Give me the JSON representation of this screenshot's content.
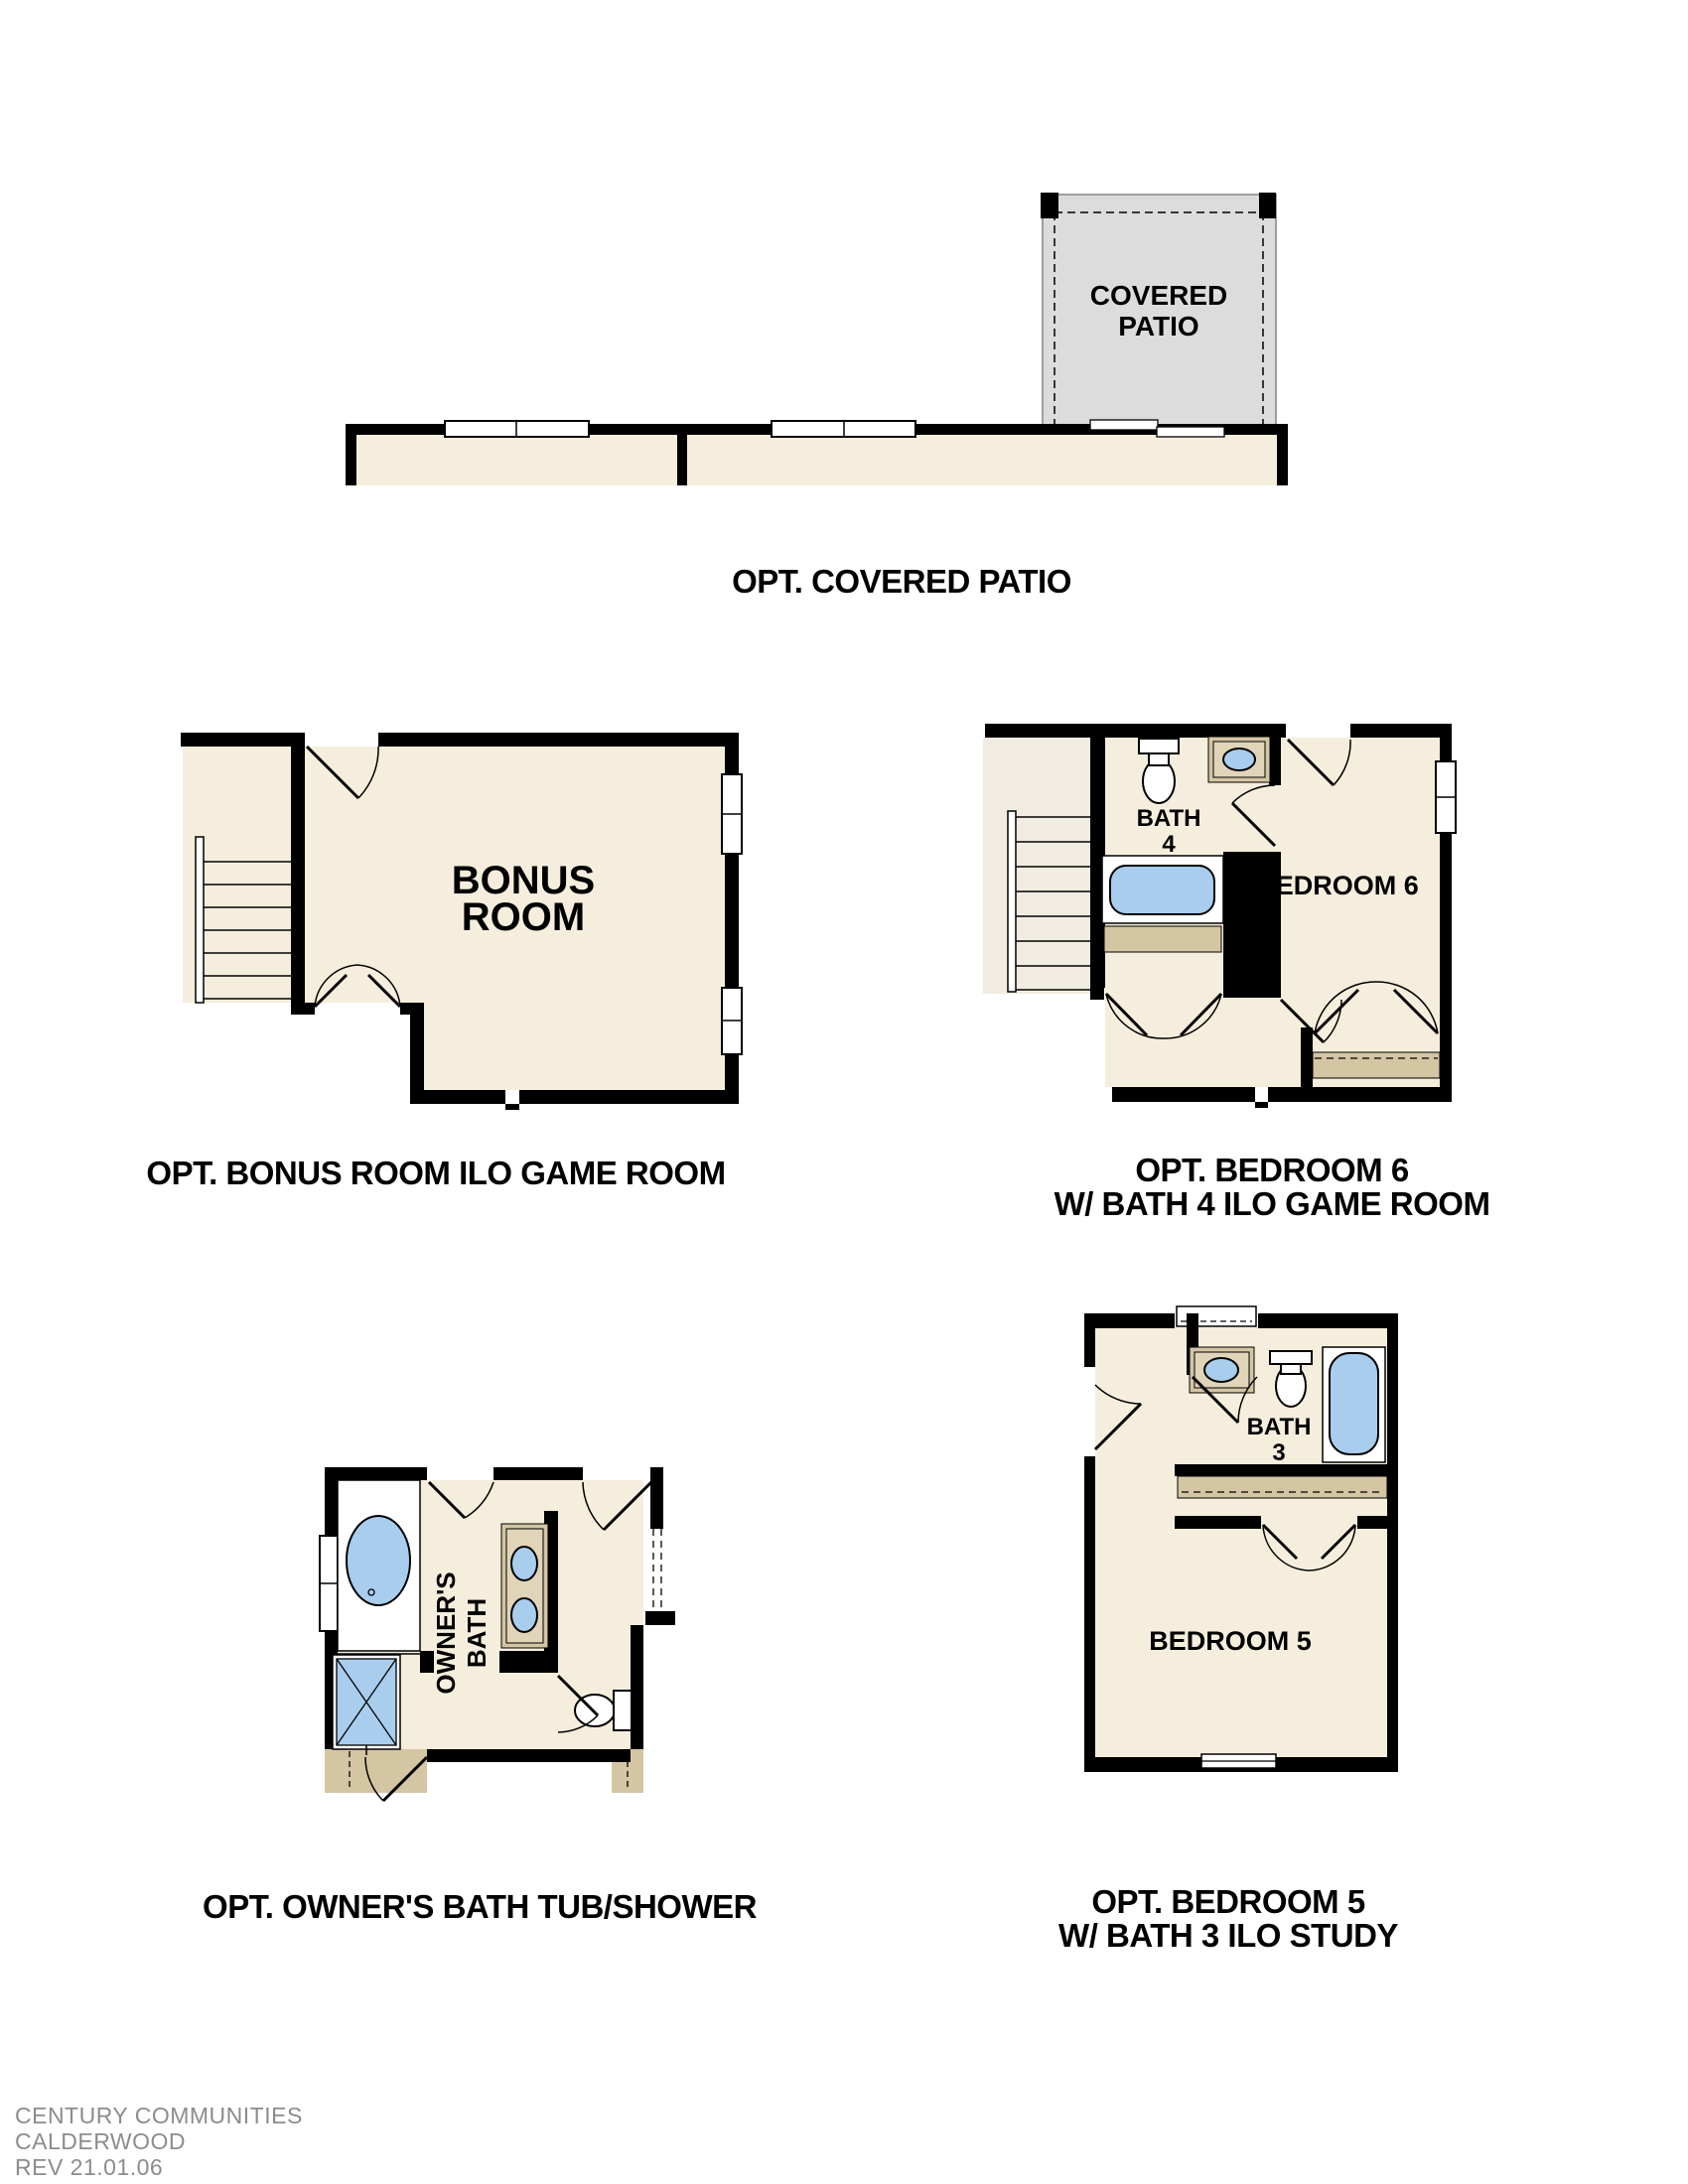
{
  "document": {
    "type": "floor-plan-options-sheet",
    "background": "#ffffff"
  },
  "colors": {
    "floor_beige": "#f5eedd",
    "stair_beige": "#f1ece1",
    "counter_tan": "#d4c5a3",
    "counter_tan_light": "#e0d5b9",
    "fixture_blue": "#a9cdec",
    "patio_gray": "#dcdcdc",
    "wall_black": "#000000",
    "footer_gray": "#8c8c8c"
  },
  "plans": {
    "covered_patio": {
      "caption": "OPT. COVERED PATIO",
      "room_label_line1": "COVERED",
      "room_label_line2": "PATIO"
    },
    "bonus_room": {
      "caption": "OPT. BONUS ROOM ILO GAME ROOM",
      "room_label_line1": "BONUS",
      "room_label_line2": "ROOM"
    },
    "bedroom6": {
      "caption_line1": "OPT. BEDROOM 6",
      "caption_line2": "W/ BATH 4 ILO GAME ROOM",
      "room_label": "BEDROOM 6",
      "bath_label_line1": "BATH",
      "bath_label_line2": "4"
    },
    "owners_bath": {
      "caption": "OPT. OWNER'S BATH TUB/SHOWER",
      "room_label_line1": "OWNER'S",
      "room_label_line2": "BATH"
    },
    "bedroom5": {
      "caption_line1": "OPT. BEDROOM 5",
      "caption_line2": "W/ BATH 3 ILO STUDY",
      "room_label": "BEDROOM 5",
      "bath_label_line1": "BATH",
      "bath_label_line2": "3"
    }
  },
  "footer": {
    "line1": "CENTURY COMMUNITIES",
    "line2": "CALDERWOOD",
    "line3": "REV 21.01.06"
  }
}
